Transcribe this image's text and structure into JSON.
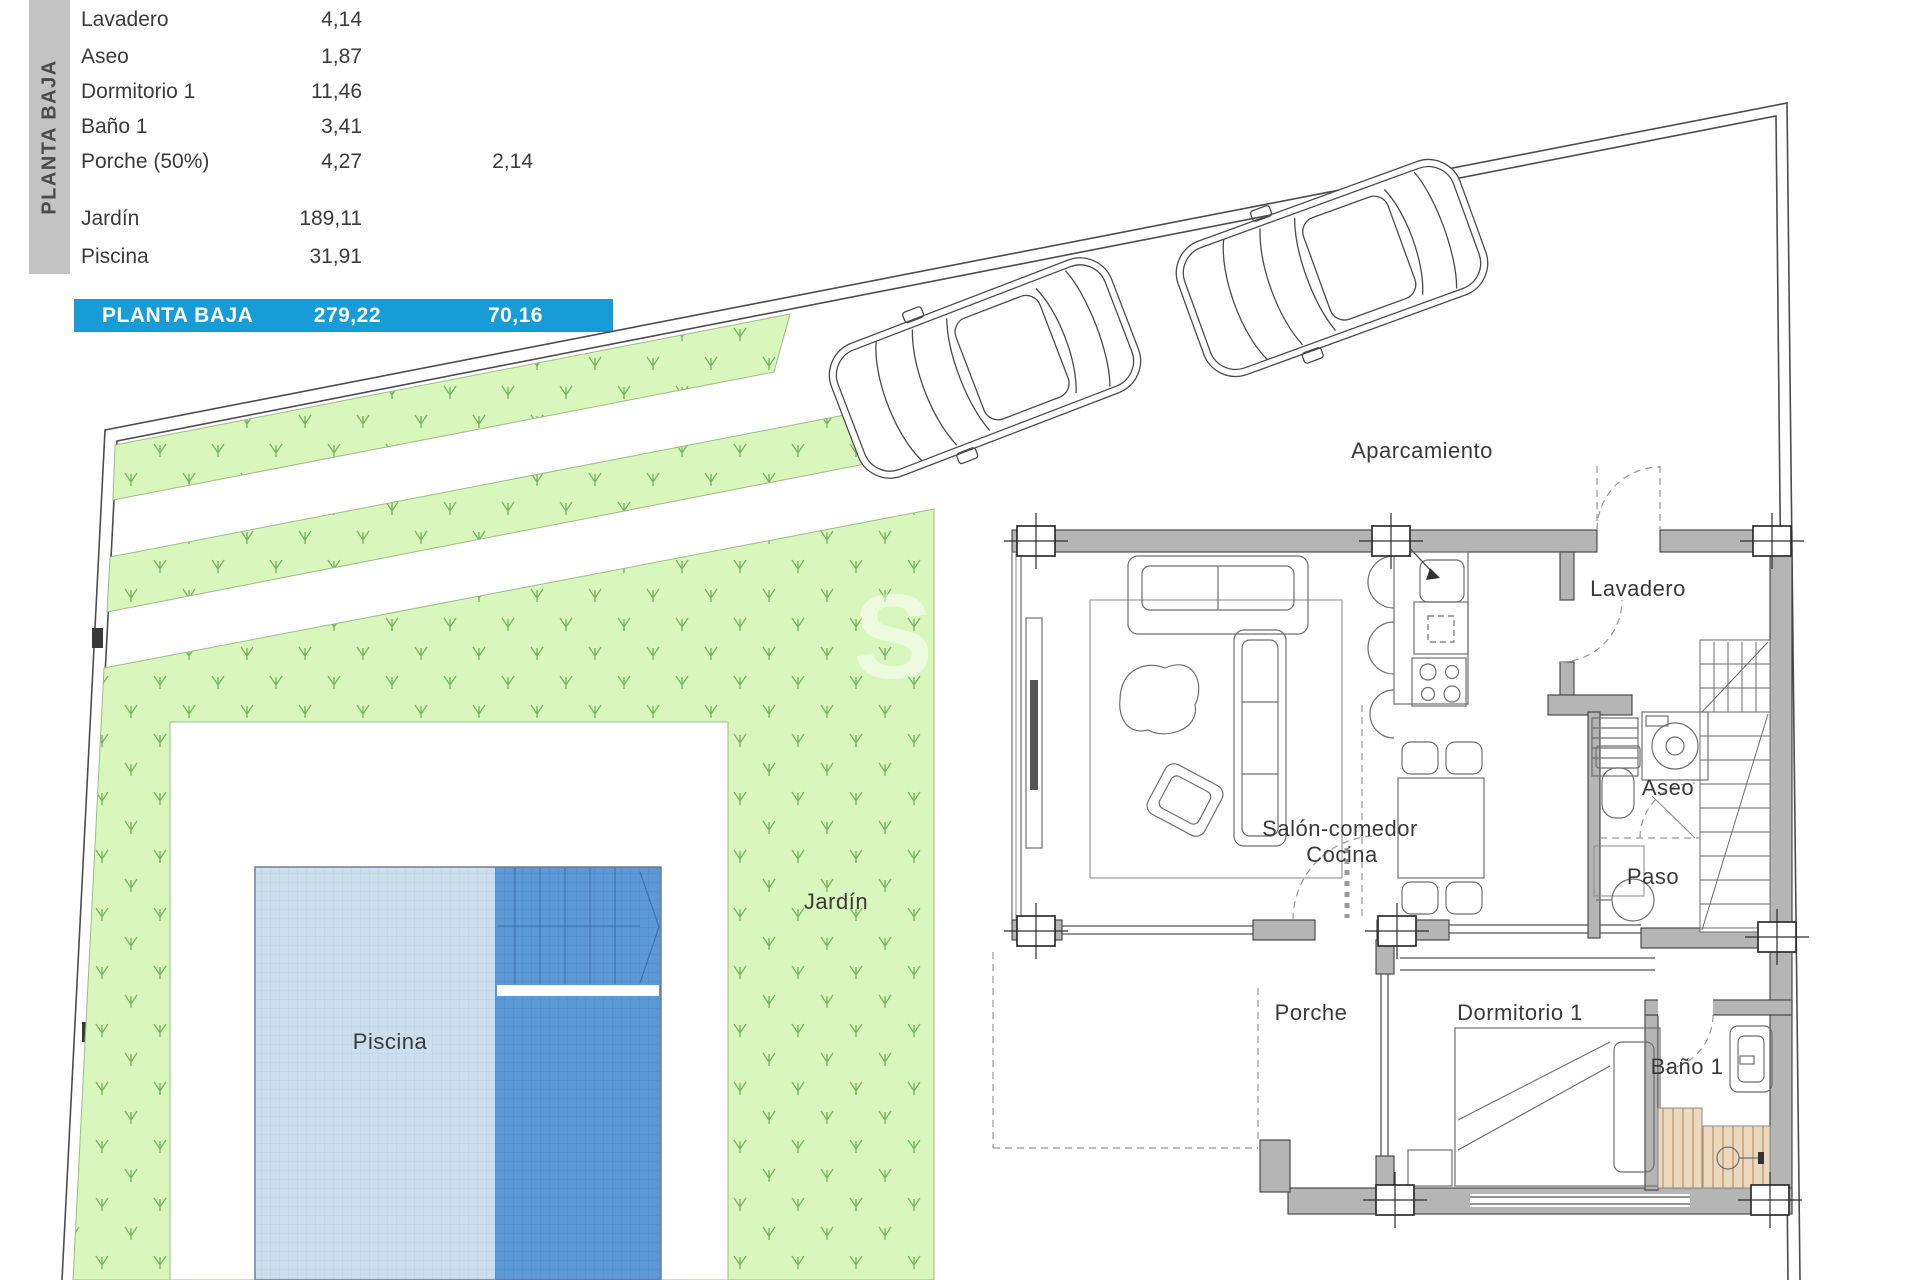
{
  "sidebar": {
    "title": "PLANTA BAJA"
  },
  "area_table": {
    "rows": [
      {
        "label": "Lavadero",
        "value": "4,14",
        "value2": ""
      },
      {
        "label": "Aseo",
        "value": "1,87",
        "value2": ""
      },
      {
        "label": "Dormitorio 1",
        "value": "11,46",
        "value2": ""
      },
      {
        "label": "Baño 1",
        "value": "3,41",
        "value2": ""
      },
      {
        "label": "Porche (50%)",
        "value": "4,27",
        "value2": "2,14"
      },
      {
        "label": "Jardín",
        "value": "189,11",
        "value2": ""
      },
      {
        "label": "Piscina",
        "value": "31,91",
        "value2": ""
      }
    ],
    "total": {
      "label": "PLANTA BAJA",
      "value": "279,22",
      "value2": "70,16"
    }
  },
  "plan": {
    "labels": {
      "aparcamiento": "Aparcamiento",
      "lavadero": "Lavadero",
      "aseo": "Aseo",
      "paso": "Paso",
      "salon_comedor": "Salón-comedor",
      "cocina": "Cocina",
      "porche": "Porche",
      "dormitorio": "Dormitorio 1",
      "bano": "Baño 1",
      "jardin": "Jardín",
      "piscina": "Piscina"
    },
    "watermark": "S"
  },
  "colors": {
    "blue_bar": "#189cd8",
    "sidebar_bg": "#c3c3c3",
    "sidebar_text": "#4a4a4a",
    "table_text": "#3b3b3b",
    "garden_fill": "#d9f6bc",
    "sprout": "#61a84e",
    "pool_light": "#cddfee",
    "pool_dark": "#5d99d6",
    "wall_fill": "#b5b5b5",
    "wall_stroke": "#3d3d3d",
    "label": "#3a3a3a",
    "shower_fill": "#ecd9bd",
    "shower_stripe": "#bd9a74"
  }
}
